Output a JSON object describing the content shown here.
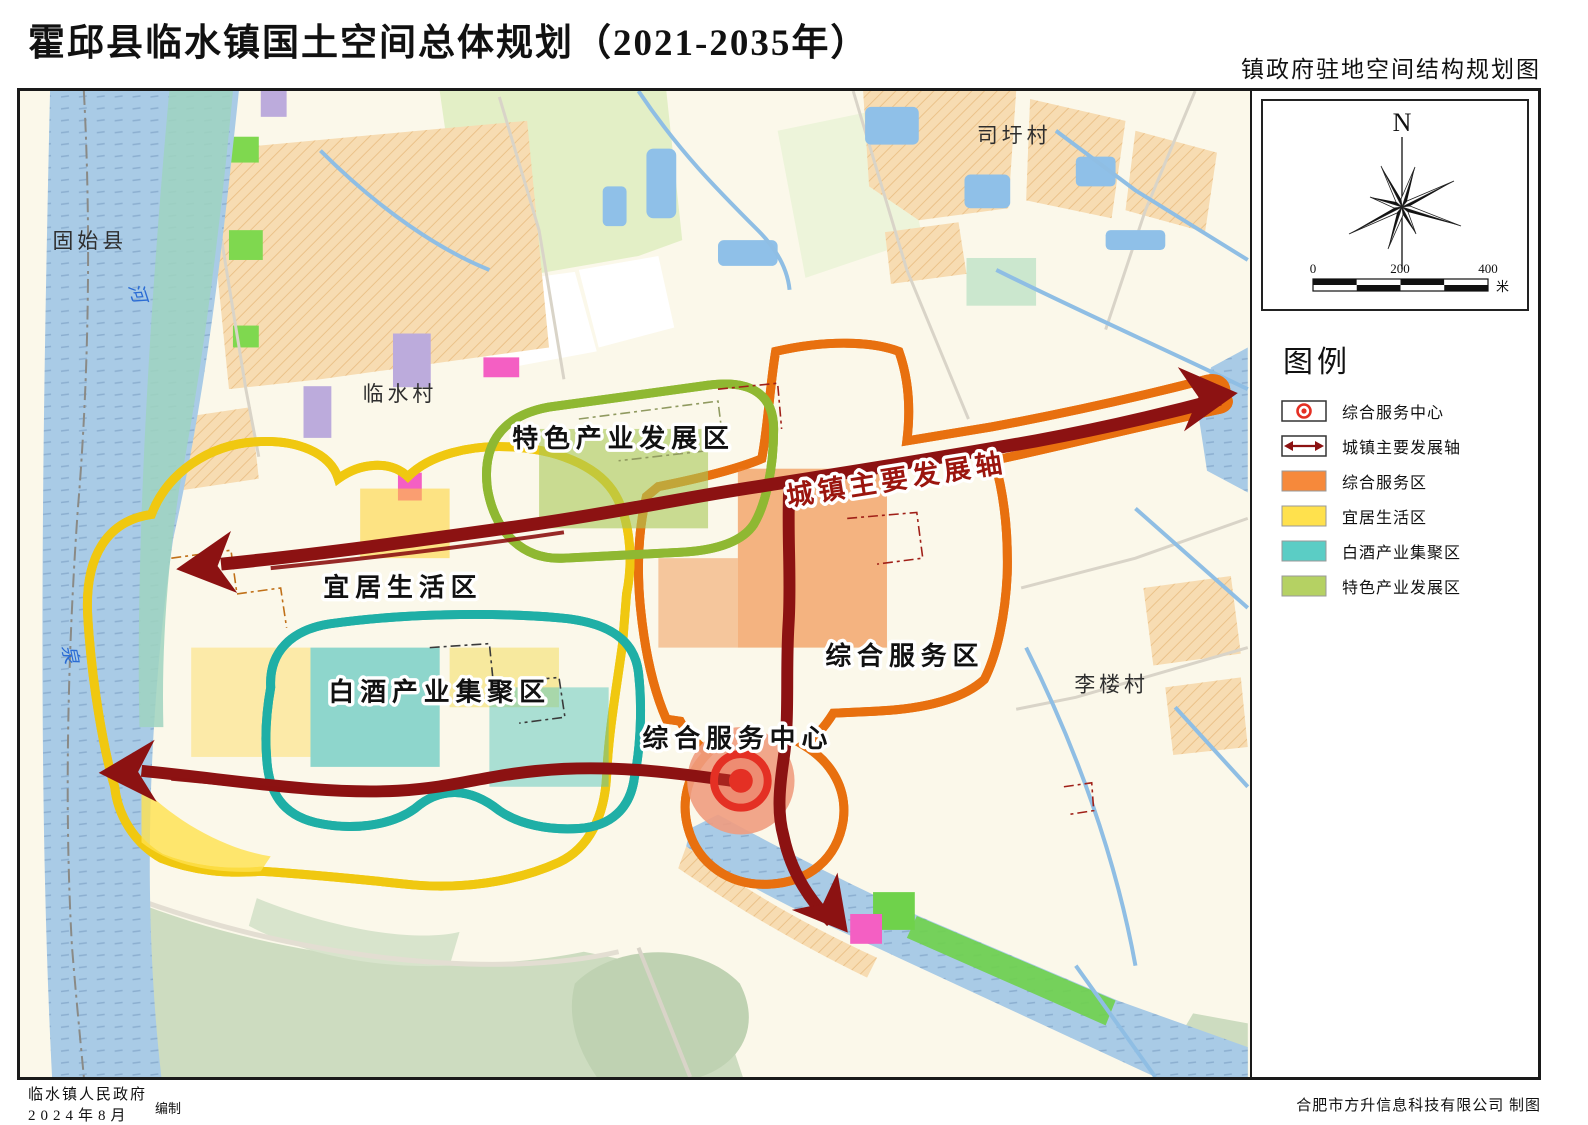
{
  "page": {
    "title": "霍邱县临水镇国土空间总体规划（2021-2035年）",
    "subtitle": "镇政府驻地空间结构规划图"
  },
  "map": {
    "zone_labels": {
      "special_industry": "特色产业发展区",
      "livable": "宜居生活区",
      "baijiu": "白酒产业集聚区",
      "service_zone": "综合服务区",
      "service_center": "综合服务中心",
      "dev_axis": "城镇主要发展轴"
    },
    "place_labels": {
      "west_county": "固始县",
      "linshui_village": "临水村",
      "siwei_village": "司圩村",
      "lilou_village": "李楼村"
    },
    "river_chars": {
      "he": "河",
      "quan": "泉"
    }
  },
  "panel": {
    "north_label": "N",
    "scale": {
      "tick0": "0",
      "tick1": "200",
      "tick2": "400",
      "unit": "米"
    },
    "legend": {
      "title": "图例",
      "items": [
        {
          "label": "综合服务中心",
          "symbol": "bullseye-icon"
        },
        {
          "label": "城镇主要发展轴",
          "symbol": "double-arrow-icon"
        },
        {
          "label": "综合服务区",
          "color": "#F6893B"
        },
        {
          "label": "宜居生活区",
          "color": "#FFE14D"
        },
        {
          "label": "白酒产业集聚区",
          "color": "#5BCDC5"
        },
        {
          "label": "特色产业发展区",
          "color": "#B5D163"
        }
      ]
    }
  },
  "footer": {
    "org": "临水镇人民政府",
    "date": "2024年8月",
    "role": "编制",
    "credit": "合肥市方升信息科技有限公司 制图"
  },
  "colors": {
    "axis": "#8C1212",
    "center_symbol": "#E43024",
    "zone_service": "#F6893B",
    "zone_living": "#FFE14D",
    "zone_baijiu": "#5BCDC5",
    "zone_special": "#B5D163"
  }
}
